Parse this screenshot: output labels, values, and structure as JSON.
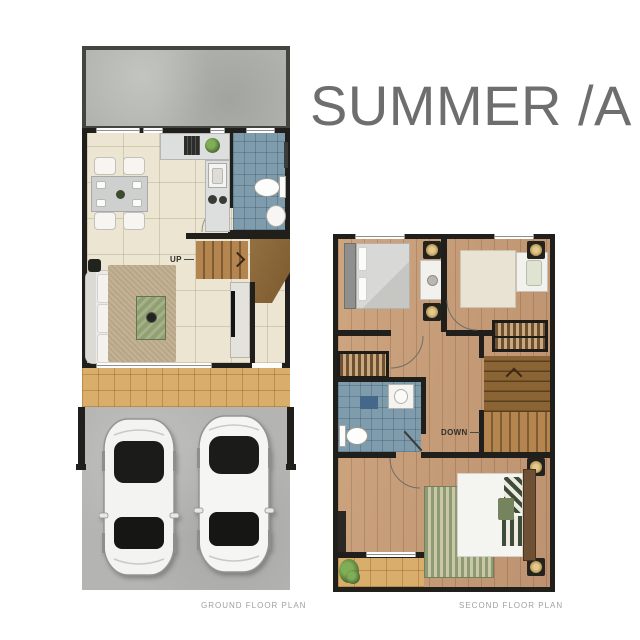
{
  "title": "SUMMER /A",
  "ground_floor": {
    "label": "GROUND FLOOR PLAN",
    "stair_label": "UP"
  },
  "second_floor": {
    "label": "SECOND FLOOR PLAN",
    "stair_label": "DOWN"
  },
  "colors": {
    "wall": "#211f1c",
    "patio": "#b2b4af",
    "tile": "#ece5d2",
    "bath": "#7e9cab",
    "porch": "#d9ae6b",
    "drive": "#b4b4b2",
    "wood": "#c69e78",
    "stair": "#b5854f",
    "stair_dark": "#8a6434",
    "rug": "#b9a687",
    "green": "#91a070",
    "counter": "#dcdfdd",
    "title_text": "#6e6e6e",
    "label_text": "#a0a0a0"
  }
}
